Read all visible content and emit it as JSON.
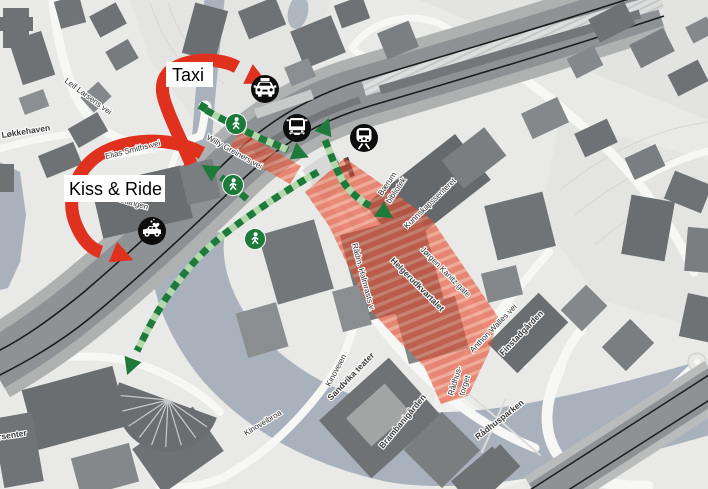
{
  "title": "Sandvika station area access map",
  "callouts": {
    "taxi": "Taxi",
    "kiss_and_ride": "Kiss & Ride"
  },
  "labels": {
    "leif_larsens_vei": "Leif Larsens vei",
    "lokkehaven": "Løkkehaven",
    "elias_smiths_vei": "Elias Smiths vei",
    "willy_greiners_vei": "Willy Greiners vei",
    "lokketangen": "Løkketangen",
    "baerum_line1": "Bærum",
    "baerum_line2": "bibliotek",
    "kunnskapssenteret": "Kunnskapssenteret",
    "jorgen_kanitz_gate": "Jørgen Kanitz gate",
    "radm_halmrasts_v": "Rådm. Halmrasts v.",
    "helgerudkvartalet": "Helgerudkvartalet",
    "anthon_walles_vei": "Anthon Walles vei",
    "finstadgarden": "Finstadgården",
    "radhustorget_line1": "Rådhus-",
    "radhustorget_line2": "torget",
    "radhusparken": "Rådhusparken",
    "kinoveien": "Kinoveien",
    "sandvika_teater": "Sandvika teater",
    "brambanigarden": "Brambanigården",
    "kinoveibroa": "Kinoveibroa",
    "storsenter": "storsenter"
  },
  "icons": {
    "taxi": "taxi-car-icon",
    "bus": "bus-icon",
    "train": "train-icon",
    "kiss_and_ride": "kiss-ride-car-icon",
    "pedestrian": "pedestrian-walking-icon"
  },
  "colors": {
    "route_red": "#e0301e",
    "pedestrian_green_dark": "#1d7a3b",
    "pedestrian_green_light": "#b2d8ab",
    "highlight_orange": "#e4482d",
    "water": "#a9b2bc",
    "building_dark": "#6f7275",
    "icon_disc": "#0d0d0d"
  }
}
